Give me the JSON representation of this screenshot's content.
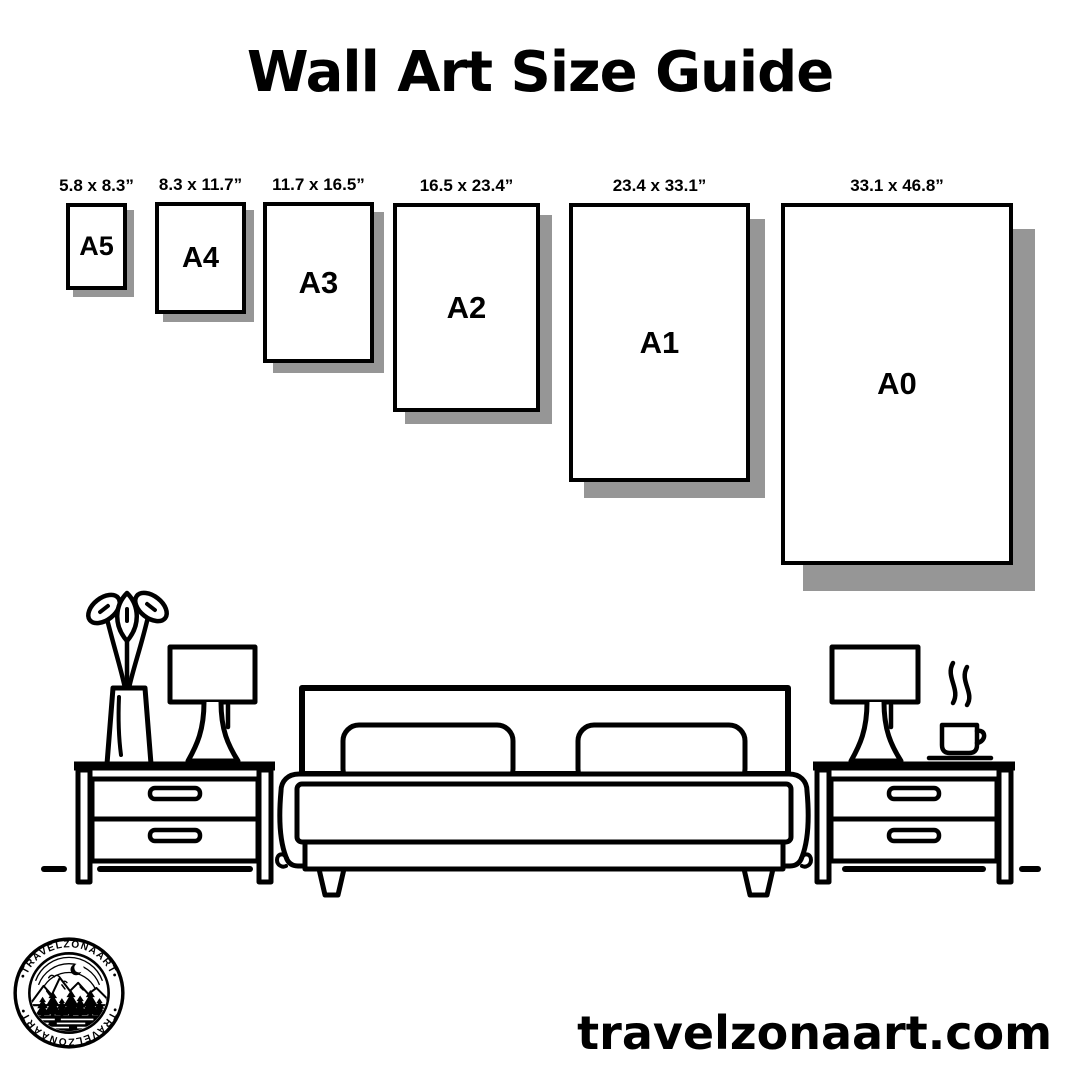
{
  "title": "Wall Art Size Guide",
  "sizes": [
    {
      "code": "A5",
      "dims": "5.8 x 8.3”"
    },
    {
      "code": "A4",
      "dims": "8.3 x 11.7”"
    },
    {
      "code": "A3",
      "dims": "11.7 x 16.5”"
    },
    {
      "code": "A2",
      "dims": "16.5 x 23.4”"
    },
    {
      "code": "A1",
      "dims": "23.4 x 33.1”"
    },
    {
      "code": "A0",
      "dims": "33.1 x 46.8”"
    }
  ],
  "footer": {
    "website": "travelzonaart.com",
    "logo_text_top": "•TRAVELZONAART•",
    "logo_text_bottom": "•TRAVELZONAART•"
  },
  "colors": {
    "ink": "#000000",
    "shadow": "#969696",
    "background": "#ffffff"
  }
}
